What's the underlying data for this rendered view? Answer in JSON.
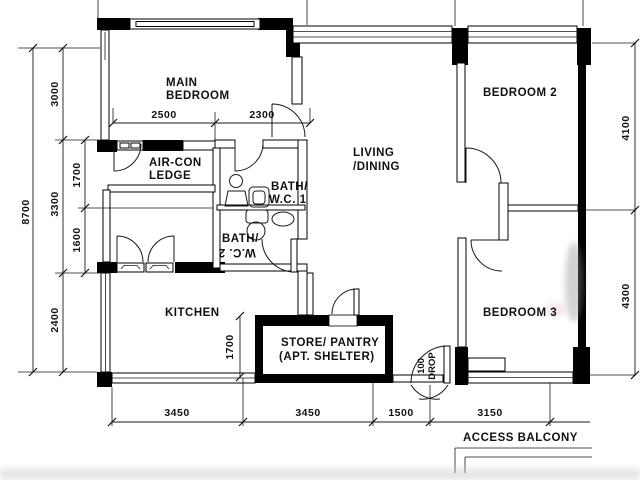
{
  "plan": {
    "rooms": {
      "main_bedroom": {
        "line1": "MAIN",
        "line2": "BEDROOM"
      },
      "aircon_ledge": {
        "line1": "AIR-CON",
        "line2": "LEDGE"
      },
      "bath1": {
        "line1": "BATH/",
        "line2": "W.C. 1"
      },
      "bath2": {
        "line1": "BATH/",
        "line2": "W.C. 2"
      },
      "living_dining": {
        "line1": "LIVING",
        "line2": "/DINING"
      },
      "kitchen": {
        "label": "KITCHEN"
      },
      "store": {
        "line1": "STORE/ PANTRY",
        "line2": "(APT. SHELTER)"
      },
      "bedroom2": {
        "label": "BEDROOM 2"
      },
      "bedroom3": {
        "label": "BEDROOM 3"
      },
      "access_balcony": {
        "label": "ACCESS BALCONY"
      },
      "entrance": {
        "drop_line1": "100",
        "drop_line2": "DROP"
      }
    },
    "dimensions": {
      "left_total": "8700",
      "left_3000": "3000",
      "left_1700": "1700",
      "left_3300": "3300",
      "left_1600": "1600",
      "left_2400": "2400",
      "top_2500": "2500",
      "top_2300": "2300",
      "right_4100": "4100",
      "right_4300": "4300",
      "bottom_3450a": "3450",
      "bottom_3450b": "3450",
      "bottom_1500": "1500",
      "bottom_3150": "3150",
      "store_1700": "1700"
    },
    "colors": {
      "wall": "#000000",
      "line": "#1a1a1a",
      "background": "#ffffff"
    }
  }
}
